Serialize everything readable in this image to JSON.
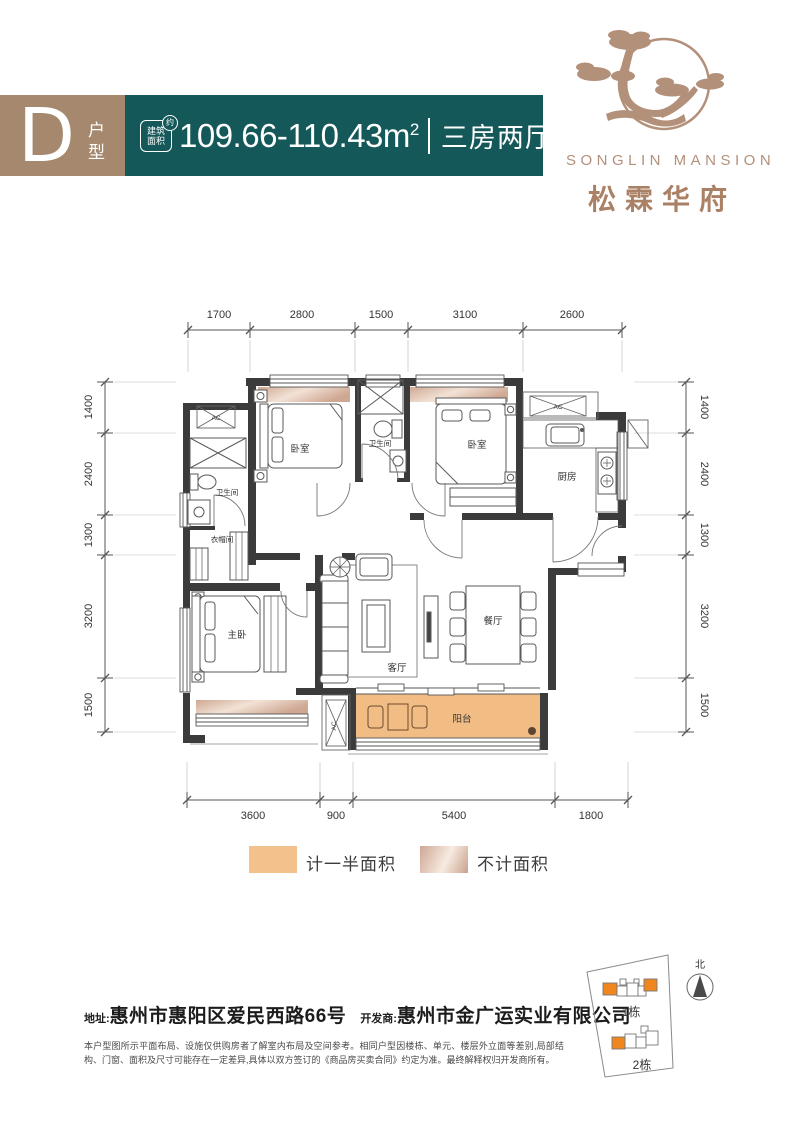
{
  "header": {
    "type_letter": "D",
    "type_label": "户型",
    "stamp_top": "建筑",
    "stamp_bottom": "面积",
    "stamp_approx": "约",
    "area_value": "109.66-110.43m",
    "area_sup": "2",
    "layout_text": "三房两厅两卫"
  },
  "logo": {
    "name_en": "SONGLIN MANSION",
    "name_cn": "松霖华府"
  },
  "floor_plan": {
    "dims_top": [
      "1700",
      "2800",
      "1500",
      "3100",
      "2600"
    ],
    "dims_left": [
      "1400",
      "2400",
      "1300",
      "3200",
      "1500"
    ],
    "dims_right": [
      "1400",
      "2400",
      "1300",
      "3200",
      "1500"
    ],
    "dims_bottom": [
      "3600",
      "900",
      "5400",
      "1800"
    ],
    "rooms": {
      "bedroom1": "卧室",
      "bath1": "卫生间",
      "bedroom2": "卧室",
      "kitchen": "厨房",
      "bath2": "卫生间",
      "cloakroom": "衣帽间",
      "master_bedroom": "主卧",
      "living_room": "客厅",
      "dining_room": "餐厅",
      "balcony": "阳台",
      "ac_unit": "AC"
    }
  },
  "legend": {
    "half_area_label": "计一半面积",
    "excluded_area_label": "不计面积"
  },
  "footer": {
    "address_label": "地址:",
    "address": "惠州市惠阳区爱民西路66号",
    "developer_label": "开发商:",
    "developer": "惠州市金广运实业有限公司",
    "disclaimer": "本户型图所示平面布局、设施仅供购房者了解室内布局及空间参考。相同户型因楼栋、单元、楼层外立面等差别,局部结构、门窗、面积及尺寸可能存在一定差异,具体以双方签订的《商品房买卖合同》约定为准。最终解释权归开发商所有。"
  },
  "site_plan": {
    "building1": "1栋",
    "building2": "2栋",
    "north": "北"
  },
  "colors": {
    "badge_brown": "#a5886d",
    "banner_teal": "#155859",
    "logo_brown": "#b3907a",
    "balcony_orange": "#f2bd85",
    "legend_half_orange": "#f3c18c",
    "legend_excluded_tan": "#d8b7a8",
    "bay_window_tan": "#d3ae97",
    "site_unit_orange": "#f0861e",
    "wall_dark": "#3b3b3c"
  }
}
